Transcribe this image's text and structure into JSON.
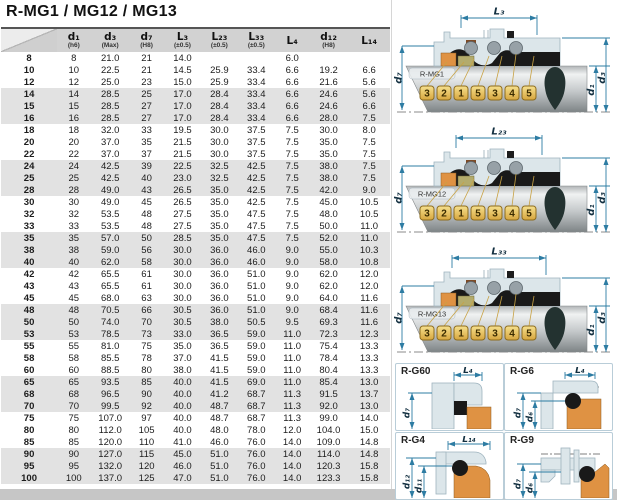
{
  "page": {
    "title": "R-MG1 / MG12 / MG13"
  },
  "table": {
    "columns": [
      {
        "label": "",
        "tol": ""
      },
      {
        "label": "d₁",
        "tol": "(h6)"
      },
      {
        "label": "d₃",
        "tol": "(Max)"
      },
      {
        "label": "d₇",
        "tol": "(H8)"
      },
      {
        "label": "L₃",
        "tol": "(±0.5)"
      },
      {
        "label": "L₂₃",
        "tol": "(±0.5)"
      },
      {
        "label": "L₃₃",
        "tol": "(±0.5)"
      },
      {
        "label": "L₄",
        "tol": ""
      },
      {
        "label": "d₁₂",
        "tol": "(H8)"
      },
      {
        "label": "L₁₄",
        "tol": ""
      }
    ],
    "rows": [
      [
        "8",
        "8",
        "21.0",
        "21",
        "14.0",
        "",
        "",
        "6.0",
        "",
        ""
      ],
      [
        "10",
        "10",
        "22.5",
        "21",
        "14.5",
        "25.9",
        "33.4",
        "6.6",
        "19.2",
        "6.6"
      ],
      [
        "12",
        "12",
        "25.0",
        "23",
        "15.0",
        "25.9",
        "33.4",
        "6.6",
        "21.6",
        "5.6"
      ],
      [
        "14",
        "14",
        "28.5",
        "25",
        "17.0",
        "28.4",
        "33.4",
        "6.6",
        "24.6",
        "5.6"
      ],
      [
        "15",
        "15",
        "28.5",
        "27",
        "17.0",
        "28.4",
        "33.4",
        "6.6",
        "24.6",
        "6.6"
      ],
      [
        "16",
        "16",
        "28.5",
        "27",
        "17.0",
        "28.4",
        "33.4",
        "6.6",
        "28.0",
        "7.5"
      ],
      [
        "18",
        "18",
        "32.0",
        "33",
        "19.5",
        "30.0",
        "37.5",
        "7.5",
        "30.0",
        "8.0"
      ],
      [
        "20",
        "20",
        "37.0",
        "35",
        "21.5",
        "30.0",
        "37.5",
        "7.5",
        "35.0",
        "7.5"
      ],
      [
        "22",
        "22",
        "37.0",
        "37",
        "21.5",
        "30.0",
        "37.5",
        "7.5",
        "35.0",
        "7.5"
      ],
      [
        "24",
        "24",
        "42.5",
        "39",
        "22.5",
        "32.5",
        "42.5",
        "7.5",
        "38.0",
        "7.5"
      ],
      [
        "25",
        "25",
        "42.5",
        "40",
        "23.0",
        "32.5",
        "42.5",
        "7.5",
        "38.0",
        "7.5"
      ],
      [
        "28",
        "28",
        "49.0",
        "43",
        "26.5",
        "35.0",
        "42.5",
        "7.5",
        "42.0",
        "9.0"
      ],
      [
        "30",
        "30",
        "49.0",
        "45",
        "26.5",
        "35.0",
        "42.5",
        "7.5",
        "45.0",
        "10.5"
      ],
      [
        "32",
        "32",
        "53.5",
        "48",
        "27.5",
        "35.0",
        "47.5",
        "7.5",
        "48.0",
        "10.5"
      ],
      [
        "33",
        "33",
        "53.5",
        "48",
        "27.5",
        "35.0",
        "47.5",
        "7.5",
        "50.0",
        "11.0"
      ],
      [
        "35",
        "35",
        "57.0",
        "50",
        "28.5",
        "35.0",
        "47.5",
        "7.5",
        "52.0",
        "11.0"
      ],
      [
        "38",
        "38",
        "59.0",
        "56",
        "30.0",
        "36.0",
        "46.0",
        "9.0",
        "55.0",
        "10.3"
      ],
      [
        "40",
        "40",
        "62.0",
        "58",
        "30.0",
        "36.0",
        "46.0",
        "9.0",
        "58.0",
        "10.8"
      ],
      [
        "42",
        "42",
        "65.5",
        "61",
        "30.0",
        "36.0",
        "51.0",
        "9.0",
        "62.0",
        "12.0"
      ],
      [
        "43",
        "43",
        "65.5",
        "61",
        "30.0",
        "36.0",
        "51.0",
        "9.0",
        "62.0",
        "12.0"
      ],
      [
        "45",
        "45",
        "68.0",
        "63",
        "30.0",
        "36.0",
        "51.0",
        "9.0",
        "64.0",
        "11.6"
      ],
      [
        "48",
        "48",
        "70.5",
        "66",
        "30.5",
        "36.0",
        "51.0",
        "9.0",
        "68.4",
        "11.6"
      ],
      [
        "50",
        "50",
        "74.0",
        "70",
        "30.5",
        "38.0",
        "50.5",
        "9.5",
        "69.3",
        "11.6"
      ],
      [
        "53",
        "53",
        "78.5",
        "73",
        "33.0",
        "36.5",
        "59.0",
        "11.0",
        "72.3",
        "12.3"
      ],
      [
        "55",
        "55",
        "81.0",
        "75",
        "35.0",
        "36.5",
        "59.0",
        "11.0",
        "75.4",
        "13.3"
      ],
      [
        "58",
        "58",
        "85.5",
        "78",
        "37.0",
        "41.5",
        "59.0",
        "11.0",
        "78.4",
        "13.3"
      ],
      [
        "60",
        "60",
        "88.5",
        "80",
        "38.0",
        "41.5",
        "59.0",
        "11.0",
        "80.4",
        "13.3"
      ],
      [
        "65",
        "65",
        "93.5",
        "85",
        "40.0",
        "41.5",
        "69.0",
        "11.0",
        "85.4",
        "13.0"
      ],
      [
        "68",
        "68",
        "96.5",
        "90",
        "40.0",
        "41.2",
        "68.7",
        "11.3",
        "91.5",
        "13.7"
      ],
      [
        "70",
        "70",
        "99.5",
        "92",
        "40.0",
        "48.7",
        "68.7",
        "11.3",
        "92.0",
        "13.0"
      ],
      [
        "75",
        "75",
        "107.0",
        "97",
        "40.0",
        "48.7",
        "68.7",
        "11.3",
        "99.0",
        "14.0"
      ],
      [
        "80",
        "80",
        "112.0",
        "105",
        "40.0",
        "48.0",
        "78.0",
        "12.0",
        "104.0",
        "15.0"
      ],
      [
        "85",
        "85",
        "120.0",
        "110",
        "41.0",
        "46.0",
        "76.0",
        "14.0",
        "109.0",
        "14.8"
      ],
      [
        "90",
        "90",
        "127.0",
        "115",
        "45.0",
        "51.0",
        "76.0",
        "14.0",
        "114.0",
        "14.8"
      ],
      [
        "95",
        "95",
        "132.0",
        "120",
        "46.0",
        "51.0",
        "76.0",
        "14.0",
        "120.3",
        "15.8"
      ],
      [
        "100",
        "100",
        "137.0",
        "125",
        "47.0",
        "51.0",
        "76.0",
        "14.0",
        "123.3",
        "15.8"
      ]
    ]
  },
  "diagrams": [
    {
      "name": "R-MG1",
      "top_dim": "L₃",
      "left_dim": "d₇",
      "right_dims": [
        "d₁",
        "d₃"
      ],
      "callouts": [
        "3",
        "2",
        "1",
        "5",
        "3",
        "4",
        "5"
      ]
    },
    {
      "name": "R-MG12",
      "top_dim": "L₂₃",
      "left_dim": "d₇",
      "right_dims": [
        "d₁",
        "d₃"
      ],
      "callouts": [
        "3",
        "2",
        "1",
        "5",
        "3",
        "4",
        "5"
      ]
    },
    {
      "name": "R-MG13",
      "top_dim": "L₃₃",
      "left_dim": "d₇",
      "right_dims": [
        "d₁",
        "d₃"
      ],
      "callouts": [
        "3",
        "2",
        "1",
        "5",
        "3",
        "4",
        "5"
      ]
    }
  ],
  "detail_panels": [
    {
      "name": "R-G60",
      "top_dim": "L₄",
      "left_dims": [
        "d₇"
      ]
    },
    {
      "name": "R-G6",
      "top_dim": "L₄",
      "left_dims": [
        "d₇",
        "d₆"
      ]
    },
    {
      "name": "R-G4",
      "top_dim": "L₁₄",
      "left_dims": [
        "d₁₂",
        "d₁₁"
      ]
    },
    {
      "name": "R-G9",
      "left_dims": [
        "d₇",
        "d₆"
      ]
    }
  ],
  "colors": {
    "dim_line": "#2d7ca3",
    "callout_gold": "#e3b84d",
    "orange_part": "#df9243",
    "tan_part": "#b3ab6c",
    "housing": "#dce6ea",
    "header_gray": "#d2d2d2",
    "band_gray": "#e2e2e2"
  }
}
